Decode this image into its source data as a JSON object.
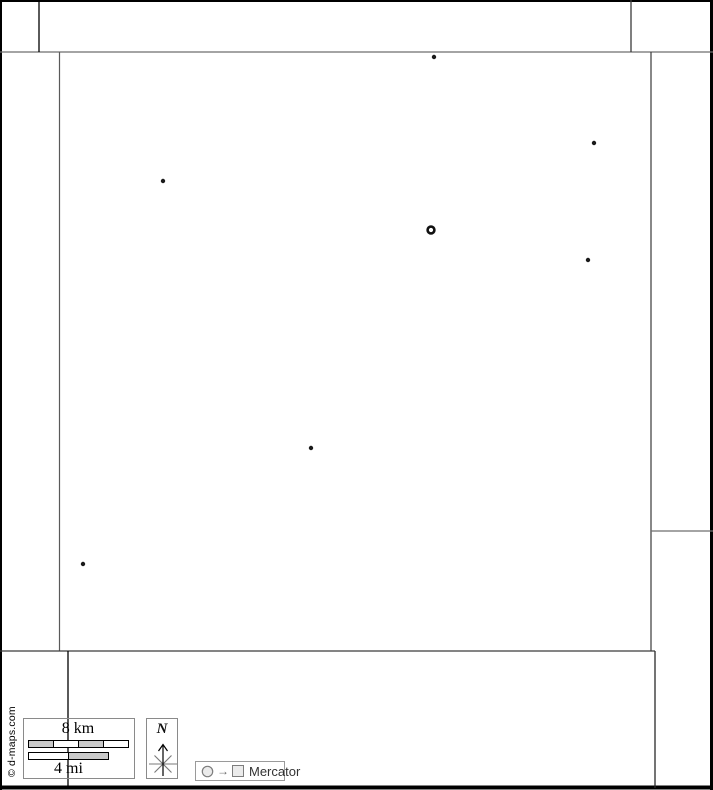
{
  "canvas": {
    "width": 713,
    "height": 790,
    "background": "#ffffff"
  },
  "copyright": {
    "text": "© d-maps.com"
  },
  "map": {
    "default_line_color": "#3d3d3d",
    "boundaries": [
      {
        "x1": 0,
        "y1": 1,
        "x2": 713,
        "y2": 1,
        "w": 2,
        "c": "#000000"
      },
      {
        "x1": 1,
        "y1": 0,
        "x2": 1,
        "y2": 790,
        "w": 2,
        "c": "#000000"
      },
      {
        "x1": 711.5,
        "y1": 0,
        "x2": 711.5,
        "y2": 790,
        "w": 3,
        "c": "#000000"
      },
      {
        "x1": 0,
        "y1": 787.5,
        "x2": 713,
        "y2": 787.5,
        "w": 4,
        "c": "#000000"
      },
      {
        "x1": 0,
        "y1": 52,
        "x2": 713,
        "y2": 52,
        "w": 1.2,
        "c": "#6e6e6e"
      },
      {
        "x1": 39,
        "y1": 0,
        "x2": 39,
        "y2": 52,
        "w": 1.3,
        "c": "#000000"
      },
      {
        "x1": 631,
        "y1": 0,
        "x2": 631,
        "y2": 52,
        "w": 1.3,
        "c": "#3a3a3a"
      },
      {
        "x1": 59.5,
        "y1": 52,
        "x2": 59.5,
        "y2": 651,
        "w": 1.2,
        "c": "#5a5a5a"
      },
      {
        "x1": 651,
        "y1": 52,
        "x2": 651,
        "y2": 651,
        "w": 1.2,
        "c": "#3a3a3a"
      },
      {
        "x1": 651,
        "y1": 531,
        "x2": 713,
        "y2": 531,
        "w": 1.2,
        "c": "#6e6e6e"
      },
      {
        "x1": 0,
        "y1": 651,
        "x2": 655,
        "y2": 651,
        "w": 1.2,
        "c": "#3a3a3a"
      },
      {
        "x1": 655,
        "y1": 651,
        "x2": 655,
        "y2": 788,
        "w": 1.3,
        "c": "#2a2a2a"
      },
      {
        "x1": 68,
        "y1": 651,
        "x2": 68,
        "y2": 788,
        "w": 1.3,
        "c": "#000000"
      }
    ],
    "markers": {
      "dot_color": "#1a1a1a",
      "dot_radius": 2.2,
      "dots": [
        {
          "x": 434,
          "y": 57
        },
        {
          "x": 594,
          "y": 143
        },
        {
          "x": 163,
          "y": 181
        },
        {
          "x": 588,
          "y": 260
        },
        {
          "x": 311,
          "y": 448
        },
        {
          "x": 83,
          "y": 564
        }
      ],
      "capital": {
        "x": 431,
        "y": 230,
        "radius": 3.4,
        "ring_width": 2.6,
        "color": "#111111",
        "center_fill": "#ffffff"
      }
    }
  },
  "scale_bar": {
    "km_label": "8 km",
    "mi_label": "4 mi",
    "km_segments": [
      "#c9c9c9",
      "#ffffff",
      "#c9c9c9",
      "#ffffff"
    ],
    "mi_segments": [
      "#ffffff",
      "#c9c9c9"
    ]
  },
  "compass": {
    "label": "N"
  },
  "projection": {
    "label": "Mercator",
    "arrow_glyph": "→"
  }
}
